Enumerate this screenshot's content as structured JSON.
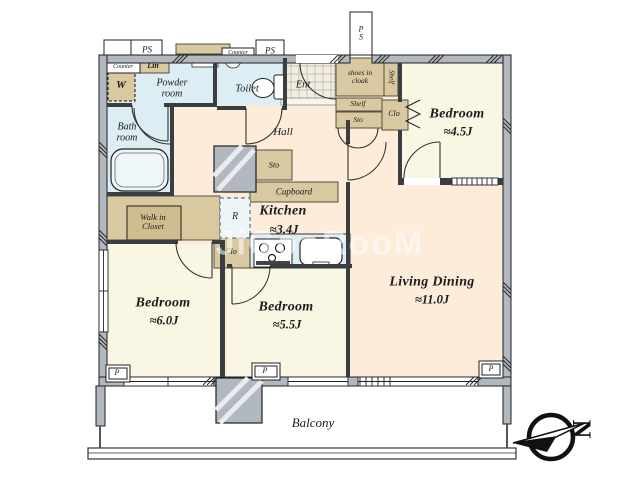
{
  "watermark": "JiGooRooM",
  "compass": {
    "letter": "N"
  },
  "rooms": {
    "bedroom_45": {
      "name": "Bedroom",
      "size": "≈4.5J"
    },
    "living_dining": {
      "name": "Living Dining",
      "size": "≈11.0J"
    },
    "kitchen": {
      "name": "Kitchen",
      "size": "≈3.4J"
    },
    "bedroom_60": {
      "name": "Bedroom",
      "size": "≈6.0J"
    },
    "bedroom_55": {
      "name": "Bedroom",
      "size": "≈5.5J"
    },
    "hall": {
      "name": "Hall"
    },
    "ent": {
      "name": "Ent"
    },
    "powder_room": {
      "name": "Powder\nroom"
    },
    "toilet": {
      "name": "Toilet"
    },
    "bath_room": {
      "name": "Bath\nroom"
    },
    "walk_in_closet": {
      "name": "Walk in\nCloset"
    },
    "shoes_in_cloak": {
      "name": "shoes in\ncloak"
    },
    "balcony": {
      "name": "Balcony"
    }
  },
  "storage": {
    "lin": "Lin",
    "washer": "W",
    "shelf": "Shelf",
    "sto": "Sto",
    "clo": "Clo",
    "cupboard": "Cupboard",
    "fridge": "R"
  },
  "utility": {
    "ps": "PS",
    "ps_shaft": "P\nS",
    "counter": "Counter",
    "pipe": "P"
  },
  "colors": {
    "room_cream": "#f9f6e3",
    "room_peach": "#fcecd9",
    "wet_blue": "#dcedf4",
    "storage_tan": "#d9c9a1",
    "wall_dark": "#3a3e42",
    "wall_outer": "#b2b8bf"
  }
}
